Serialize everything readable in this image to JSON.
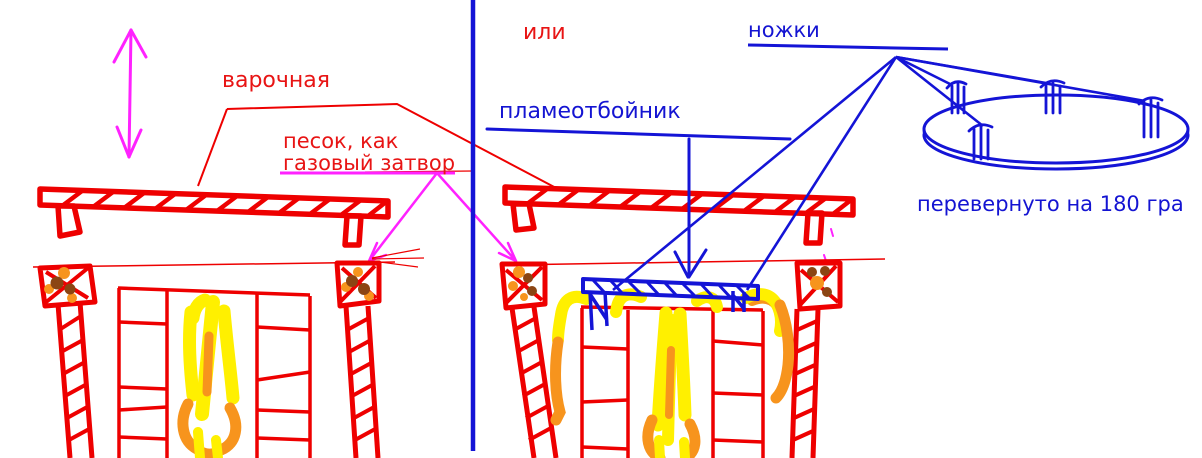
{
  "labels": {
    "cooking_surface": "варочная",
    "sand_line1": "песок, как",
    "sand_line2": "газовый затвор",
    "or_word": "или",
    "flame_deflector": "пламеотбойник",
    "legs": "ножки",
    "flipped_180": "перевернуто на 180 гра"
  },
  "palette": {
    "red": "#ee0000",
    "magenta": "#ff22ff",
    "blue": "#1414d6",
    "yellow": "#fff000",
    "orange": "#f7941d",
    "brown": "#8b4513",
    "background": "#ffffff"
  }
}
